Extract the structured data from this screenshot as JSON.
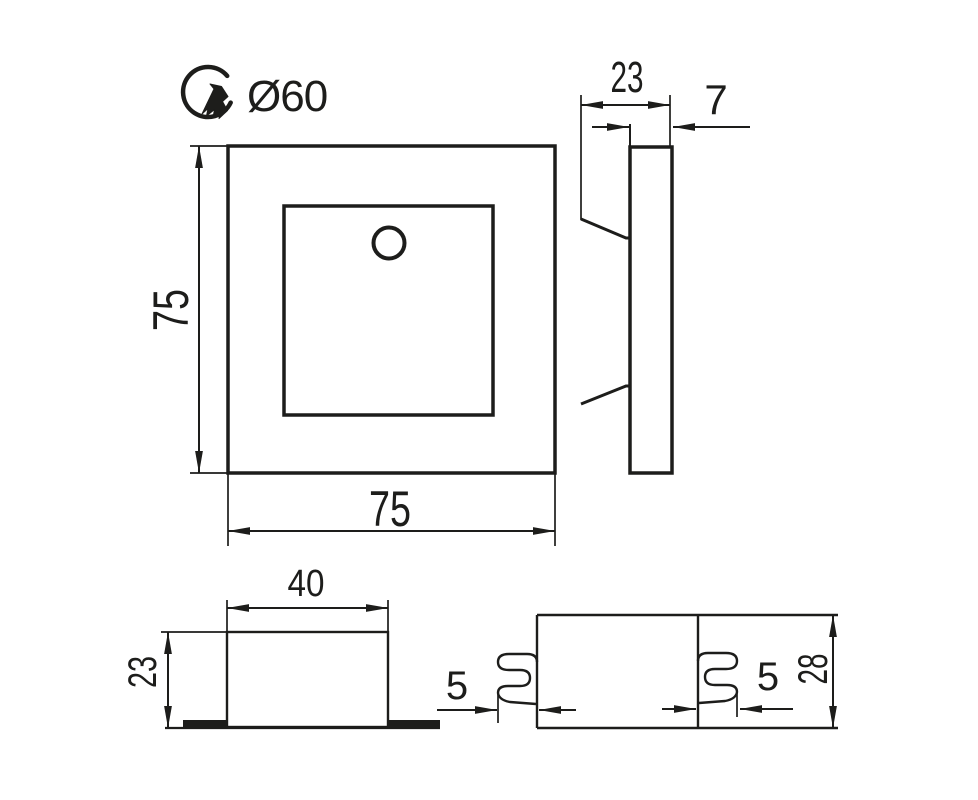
{
  "meta": {
    "description": "Technical dimension drawing of a square recessed wall / stair light fixture (front view, side view, housing section and spring-clip section)",
    "line_color": "#1d1d1b",
    "background_color": "#ffffff",
    "units_shown": "mm"
  },
  "labels": {
    "cutout_diameter": "Ø60",
    "front_height": "75",
    "front_width": "75",
    "side_depth": "23",
    "side_front_thickness": "7",
    "box_width": "40",
    "box_depth": "23",
    "clip_left_protrusion": "5",
    "clip_right_protrusion": "5",
    "box_height": "28"
  }
}
